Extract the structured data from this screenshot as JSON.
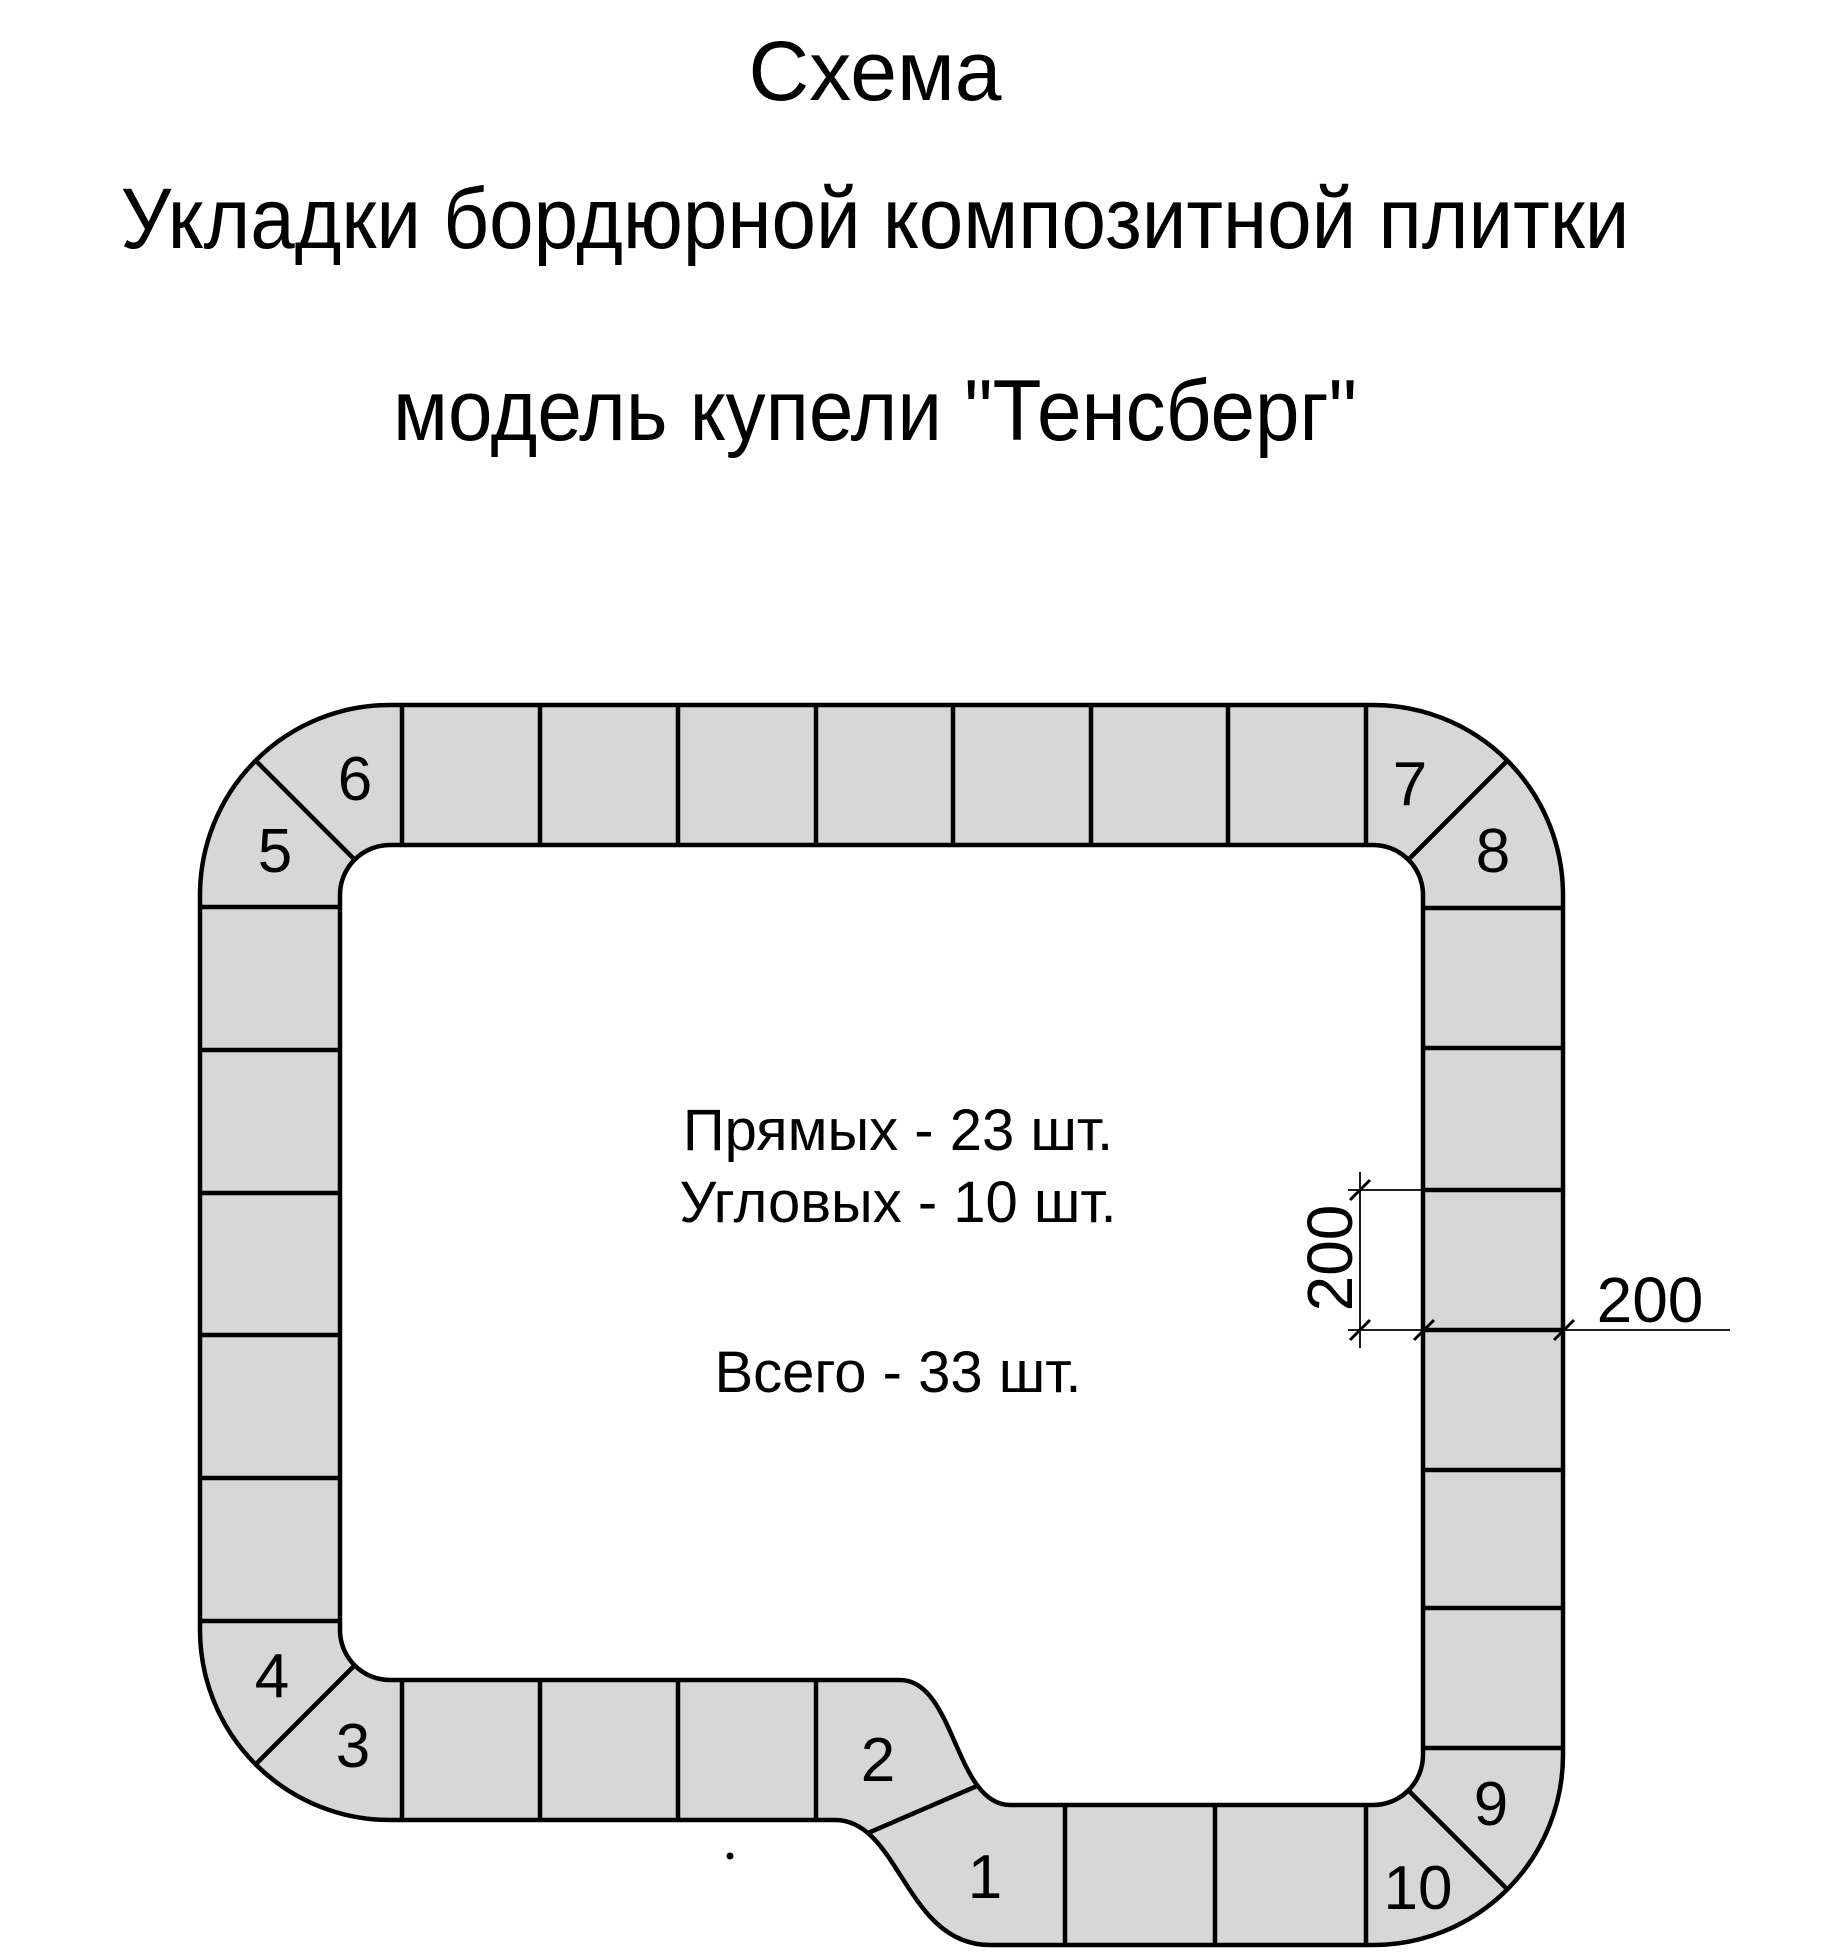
{
  "header": {
    "title": "Схема",
    "subtitle1": "Укладки бордюрной композитной плитки",
    "subtitle2": "модель купели \"Тенсберг\""
  },
  "summary": {
    "straight": "Прямых - 23 шт.",
    "corner": "Угловых - 10 шт.",
    "total": "Всего - 33 шт."
  },
  "diagram": {
    "corner_labels": {
      "c1": "1",
      "c2": "2",
      "c3": "3",
      "c4": "4",
      "c5": "5",
      "c6": "6",
      "c7": "7",
      "c8": "8",
      "c9": "9",
      "c10": "10"
    },
    "dimensions": {
      "tile_length_mm": "200",
      "tile_width_mm": "200"
    },
    "counts": {
      "straight_tiles": 23,
      "corner_tiles": 10,
      "total_tiles": 33
    },
    "colors": {
      "tile_fill": "#d7d7d7",
      "line": "#000000"
    }
  }
}
